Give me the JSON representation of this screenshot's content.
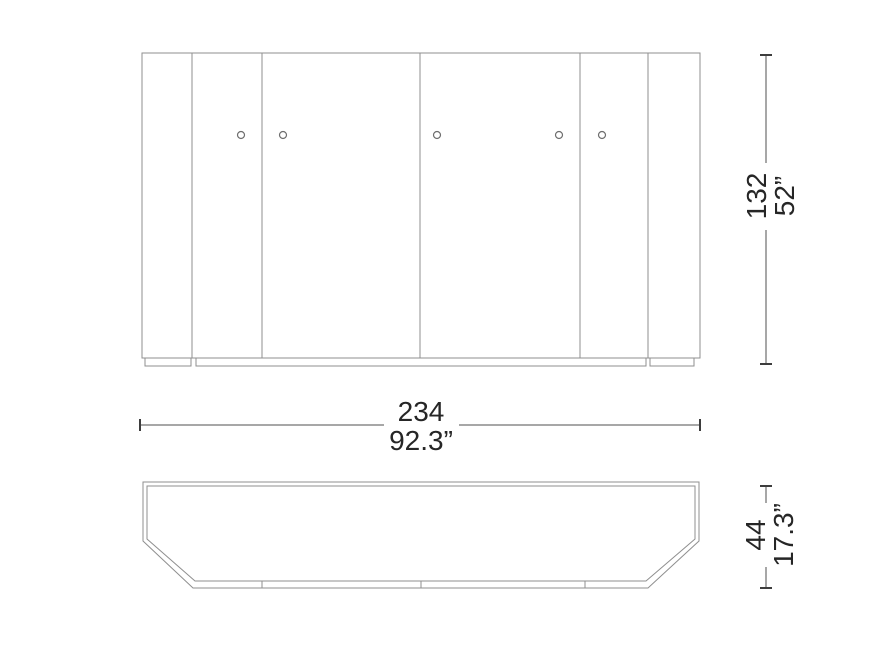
{
  "page": {
    "background": "#ffffff",
    "description": "Technical dimension drawing of a sideboard cabinet: front elevation with five doors and knobs above a recessed plinth, and a plan (top) view with chamfered front corners"
  },
  "drawing": {
    "colors": {
      "outline_line": "#8f8f8f",
      "dimension_line": "#4f4f4f",
      "text": "#262626"
    },
    "views": {
      "front_view_name": "front-elevation",
      "top_view_name": "plan-view"
    },
    "dimensions": {
      "width": {
        "cm": "234",
        "in": "92.3”"
      },
      "height": {
        "cm": "132",
        "in": "52”"
      },
      "depth": {
        "cm": "44",
        "in": "17.3”"
      }
    }
  }
}
